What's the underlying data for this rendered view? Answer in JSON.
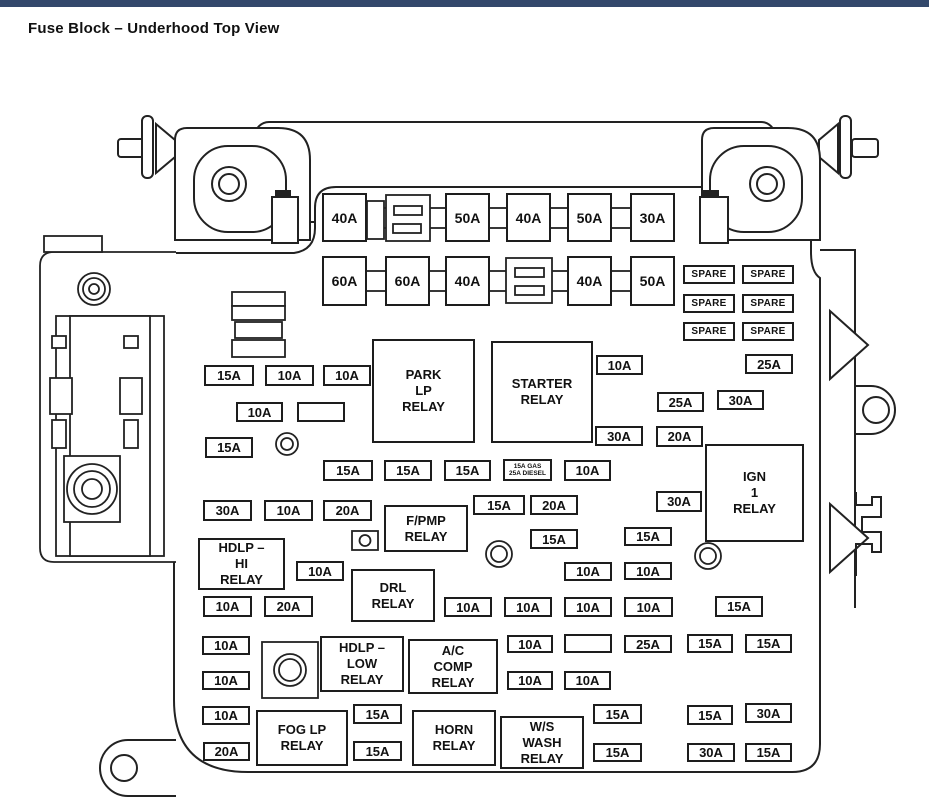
{
  "page": {
    "title": "Fuse Block – Underhood Top View",
    "top_bar_color": "#33486b",
    "line_color": "#222222",
    "background": "#ffffff"
  },
  "diagram": {
    "maxi_fuses": [
      {
        "label": "40A",
        "x": 322,
        "y": 193,
        "w": 45,
        "h": 49
      },
      {
        "label": "50A",
        "x": 445,
        "y": 193,
        "w": 45,
        "h": 49
      },
      {
        "label": "40A",
        "x": 506,
        "y": 193,
        "w": 45,
        "h": 49
      },
      {
        "label": "50A",
        "x": 567,
        "y": 193,
        "w": 45,
        "h": 49
      },
      {
        "label": "30A",
        "x": 630,
        "y": 193,
        "w": 45,
        "h": 49
      },
      {
        "label": "60A",
        "x": 322,
        "y": 256,
        "w": 45,
        "h": 50
      },
      {
        "label": "60A",
        "x": 385,
        "y": 256,
        "w": 45,
        "h": 50
      },
      {
        "label": "40A",
        "x": 445,
        "y": 256,
        "w": 45,
        "h": 50
      },
      {
        "label": "40A",
        "x": 567,
        "y": 256,
        "w": 45,
        "h": 50
      },
      {
        "label": "50A",
        "x": 630,
        "y": 256,
        "w": 45,
        "h": 50
      }
    ],
    "spare_label": "SPARE",
    "spares": [
      {
        "x": 683,
        "y": 265
      },
      {
        "x": 742,
        "y": 265
      },
      {
        "x": 683,
        "y": 294
      },
      {
        "x": 742,
        "y": 294
      },
      {
        "x": 683,
        "y": 322
      },
      {
        "x": 742,
        "y": 322
      }
    ],
    "fuses": [
      {
        "label": "15A",
        "x": 204,
        "y": 365,
        "w": 50,
        "h": 21
      },
      {
        "label": "10A",
        "x": 265,
        "y": 365,
        "w": 49,
        "h": 21
      },
      {
        "label": "10A",
        "x": 323,
        "y": 365,
        "w": 48,
        "h": 21
      },
      {
        "label": "10A",
        "x": 596,
        "y": 355,
        "w": 47,
        "h": 20
      },
      {
        "label": "25A",
        "x": 745,
        "y": 354,
        "w": 48,
        "h": 20
      },
      {
        "label": "10A",
        "x": 236,
        "y": 402,
        "w": 47,
        "h": 20
      },
      {
        "label": "",
        "x": 297,
        "y": 402,
        "w": 48,
        "h": 20
      },
      {
        "label": "25A",
        "x": 657,
        "y": 392,
        "w": 47,
        "h": 20
      },
      {
        "label": "30A",
        "x": 717,
        "y": 390,
        "w": 47,
        "h": 20
      },
      {
        "label": "15A",
        "x": 205,
        "y": 437,
        "w": 48,
        "h": 21
      },
      {
        "label": "30A",
        "x": 595,
        "y": 426,
        "w": 48,
        "h": 20
      },
      {
        "label": "20A",
        "x": 656,
        "y": 426,
        "w": 47,
        "h": 21
      },
      {
        "label": "15A",
        "x": 323,
        "y": 460,
        "w": 50,
        "h": 21
      },
      {
        "label": "15A",
        "x": 384,
        "y": 460,
        "w": 48,
        "h": 21
      },
      {
        "label": "15A",
        "x": 444,
        "y": 460,
        "w": 47,
        "h": 21
      },
      {
        "label": "",
        "lines": [
          "15A GAS",
          "25A DIESEL"
        ],
        "x": 503,
        "y": 459,
        "w": 49,
        "h": 22
      },
      {
        "label": "10A",
        "x": 564,
        "y": 460,
        "w": 47,
        "h": 21
      },
      {
        "label": "30A",
        "x": 203,
        "y": 500,
        "w": 49,
        "h": 21
      },
      {
        "label": "10A",
        "x": 264,
        "y": 500,
        "w": 49,
        "h": 21
      },
      {
        "label": "20A",
        "x": 323,
        "y": 500,
        "w": 49,
        "h": 21
      },
      {
        "label": "15A",
        "x": 473,
        "y": 495,
        "w": 52,
        "h": 20
      },
      {
        "label": "20A",
        "x": 530,
        "y": 495,
        "w": 48,
        "h": 20
      },
      {
        "label": "30A",
        "x": 656,
        "y": 491,
        "w": 46,
        "h": 21
      },
      {
        "label": "10A",
        "x": 296,
        "y": 561,
        "w": 48,
        "h": 20
      },
      {
        "label": "15A",
        "x": 530,
        "y": 529,
        "w": 48,
        "h": 20
      },
      {
        "label": "15A",
        "x": 624,
        "y": 527,
        "w": 48,
        "h": 19
      },
      {
        "label": "10A",
        "x": 564,
        "y": 562,
        "w": 48,
        "h": 19
      },
      {
        "label": "10A",
        "x": 624,
        "y": 562,
        "w": 48,
        "h": 18
      },
      {
        "label": "10A",
        "x": 203,
        "y": 596,
        "w": 49,
        "h": 21
      },
      {
        "label": "20A",
        "x": 264,
        "y": 596,
        "w": 49,
        "h": 21
      },
      {
        "label": "10A",
        "x": 444,
        "y": 597,
        "w": 48,
        "h": 20
      },
      {
        "label": "10A",
        "x": 504,
        "y": 597,
        "w": 48,
        "h": 20
      },
      {
        "label": "10A",
        "x": 564,
        "y": 597,
        "w": 48,
        "h": 20
      },
      {
        "label": "10A",
        "x": 624,
        "y": 597,
        "w": 49,
        "h": 20
      },
      {
        "label": "15A",
        "x": 715,
        "y": 596,
        "w": 48,
        "h": 21
      },
      {
        "label": "10A",
        "x": 202,
        "y": 636,
        "w": 48,
        "h": 19
      },
      {
        "label": "10A",
        "x": 507,
        "y": 635,
        "w": 46,
        "h": 18
      },
      {
        "label": "",
        "x": 564,
        "y": 634,
        "w": 48,
        "h": 19
      },
      {
        "label": "25A",
        "x": 624,
        "y": 635,
        "w": 48,
        "h": 18
      },
      {
        "label": "15A",
        "x": 687,
        "y": 634,
        "w": 46,
        "h": 19
      },
      {
        "label": "15A",
        "x": 745,
        "y": 634,
        "w": 47,
        "h": 19
      },
      {
        "label": "10A",
        "x": 202,
        "y": 671,
        "w": 48,
        "h": 19
      },
      {
        "label": "10A",
        "x": 507,
        "y": 671,
        "w": 46,
        "h": 19
      },
      {
        "label": "10A",
        "x": 564,
        "y": 671,
        "w": 47,
        "h": 19
      },
      {
        "label": "10A",
        "x": 202,
        "y": 706,
        "w": 48,
        "h": 19
      },
      {
        "label": "15A",
        "x": 353,
        "y": 704,
        "w": 49,
        "h": 20
      },
      {
        "label": "15A",
        "x": 593,
        "y": 704,
        "w": 49,
        "h": 20
      },
      {
        "label": "15A",
        "x": 687,
        "y": 705,
        "w": 46,
        "h": 20
      },
      {
        "label": "30A",
        "x": 745,
        "y": 703,
        "w": 47,
        "h": 20
      },
      {
        "label": "20A",
        "x": 203,
        "y": 742,
        "w": 47,
        "h": 19
      },
      {
        "label": "15A",
        "x": 353,
        "y": 741,
        "w": 49,
        "h": 20
      },
      {
        "label": "15A",
        "x": 593,
        "y": 743,
        "w": 49,
        "h": 19
      },
      {
        "label": "30A",
        "x": 687,
        "y": 743,
        "w": 48,
        "h": 19
      },
      {
        "label": "15A",
        "x": 745,
        "y": 743,
        "w": 47,
        "h": 19
      }
    ],
    "relays": [
      {
        "name": "park-lp-relay",
        "lines": [
          "PARK",
          "LP",
          "RELAY"
        ],
        "x": 372,
        "y": 339,
        "w": 103,
        "h": 104
      },
      {
        "name": "starter-relay",
        "lines": [
          "STARTER",
          "RELAY"
        ],
        "x": 491,
        "y": 341,
        "w": 102,
        "h": 102
      },
      {
        "name": "ign-1-relay",
        "lines": [
          "IGN",
          "1",
          "RELAY"
        ],
        "x": 705,
        "y": 444,
        "w": 99,
        "h": 98
      },
      {
        "name": "f-pmp-relay",
        "lines": [
          "F/PMP",
          "RELAY"
        ],
        "x": 384,
        "y": 505,
        "w": 84,
        "h": 47
      },
      {
        "name": "hdlp-hi-relay",
        "lines": [
          "HDLP –",
          "HI",
          "RELAY"
        ],
        "x": 198,
        "y": 538,
        "w": 87,
        "h": 52
      },
      {
        "name": "drl-relay",
        "lines": [
          "DRL",
          "RELAY"
        ],
        "x": 351,
        "y": 569,
        "w": 84,
        "h": 53
      },
      {
        "name": "hdlp-low-relay",
        "lines": [
          "HDLP –",
          "LOW",
          "RELAY"
        ],
        "x": 320,
        "y": 636,
        "w": 84,
        "h": 56
      },
      {
        "name": "ac-comp-relay",
        "lines": [
          "A/C",
          "COMP",
          "RELAY"
        ],
        "x": 408,
        "y": 639,
        "w": 90,
        "h": 55
      },
      {
        "name": "fog-lp-relay",
        "lines": [
          "FOG LP",
          "RELAY"
        ],
        "x": 256,
        "y": 710,
        "w": 92,
        "h": 56
      },
      {
        "name": "horn-relay",
        "lines": [
          "HORN",
          "RELAY"
        ],
        "x": 412,
        "y": 710,
        "w": 84,
        "h": 56
      },
      {
        "name": "ws-wash-relay",
        "lines": [
          "W/S",
          "WASH",
          "RELAY"
        ],
        "x": 500,
        "y": 716,
        "w": 84,
        "h": 53
      }
    ]
  }
}
